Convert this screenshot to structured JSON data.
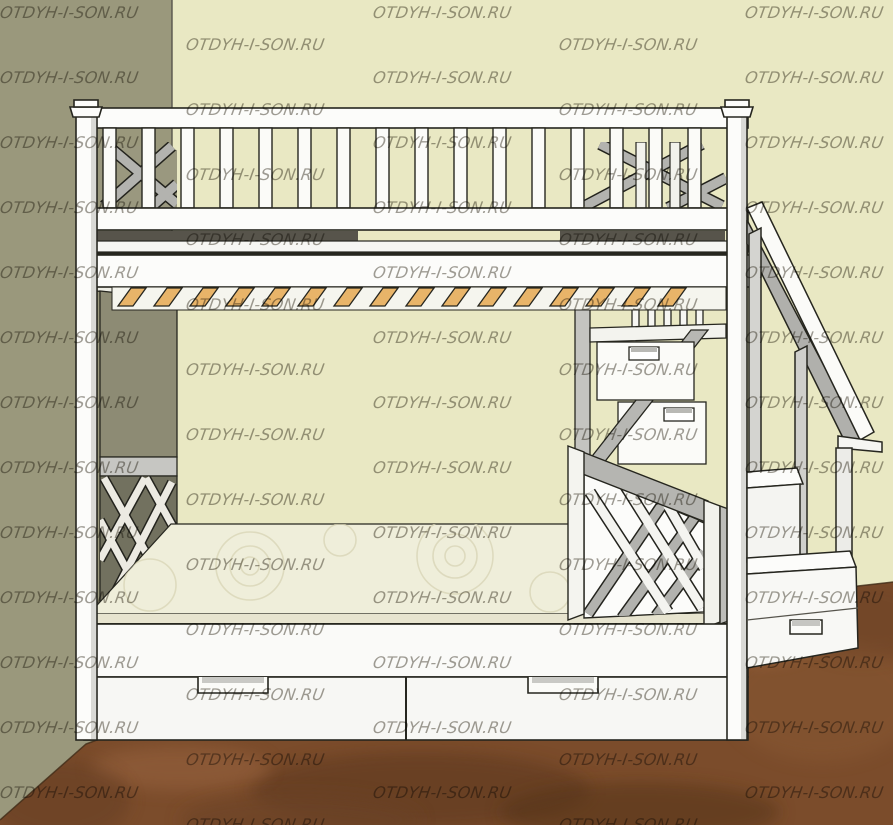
{
  "watermark": {
    "text": "OTDYH-I-SON.RU",
    "color": "rgba(72,68,54,0.52)",
    "row_spacing": 65,
    "rows_per_column": 13,
    "columns": [
      {
        "x": 0,
        "y_start": 5
      },
      {
        "x": 186,
        "y_start": 37
      },
      {
        "x": 373,
        "y_start": 5
      },
      {
        "x": 559,
        "y_start": 37
      },
      {
        "x": 745,
        "y_start": 5
      }
    ]
  },
  "scene": {
    "subject": "two-level bunk bed with under-bed drawers and staircase with storage steps",
    "colors": {
      "left_wall": "#9a987c",
      "back_wall": "#e9e8c3",
      "floor": "#7b4c2b",
      "floor_dark": "#59361d",
      "floor_light": "#986440",
      "frame_white": "#fbfbf8",
      "frame_shadow": "#b5b5b1",
      "frame_inner": "#8d8b74",
      "slats": "#e8b469",
      "mattress": "#efeeda",
      "lattice_dark": "#72715f",
      "outline": "#26261f"
    }
  }
}
